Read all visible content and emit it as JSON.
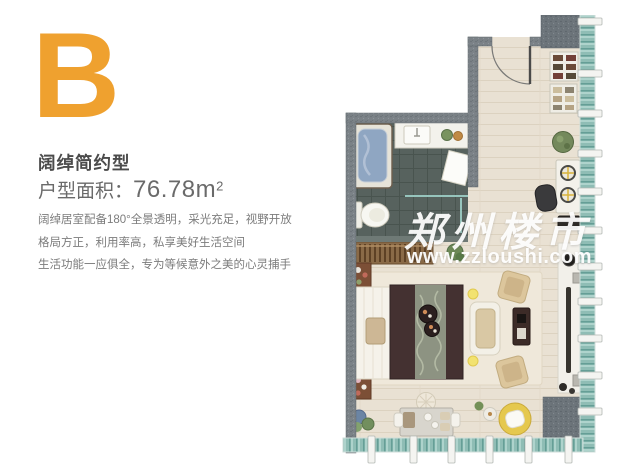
{
  "unit": {
    "letter": "B",
    "type_title": "阔绰简约型",
    "area_label": "户型面积：",
    "area_value": "76.78m",
    "area_sup": "2",
    "description": [
      "阔绰居室配备180°全景透明，采光充足，视野开放",
      "格局方正，利用率高，私享美好生活空间",
      "生活功能一应俱全，专为等候意外之美的心灵捕手"
    ]
  },
  "watermark": {
    "site_name": "郑州楼市",
    "site_url": "www.zzloushi.com"
  },
  "colors": {
    "accent_orange": "#EFA12F",
    "heading_text": "#4B4B4B",
    "body_text": "#7C7C7C",
    "wall_gray": "#7B8287",
    "floor_beige": "#E9E1D3",
    "bathroom_tile": "#57625E",
    "window_glass": "#8FBDB5",
    "bed_brown": "#443131",
    "rug_cream": "#EFE8DA",
    "chair_yellow": "#E5C84E"
  },
  "floorplan_elements": [
    "entry-door",
    "bathtub",
    "vanity-sink",
    "shower-mat",
    "toilet",
    "shower-glass",
    "wardrobe",
    "double-bed",
    "headboard",
    "decor-trays",
    "loveseat",
    "tv-cabinet",
    "lounge-chairs",
    "floor-lamps",
    "kitchen-shelves",
    "sink-plant",
    "stove",
    "coffee-machine",
    "bar-counter",
    "bar-stool",
    "dining-desk",
    "pouf",
    "yellow-armchair",
    "side-table",
    "plants",
    "window-right",
    "window-bottom"
  ]
}
